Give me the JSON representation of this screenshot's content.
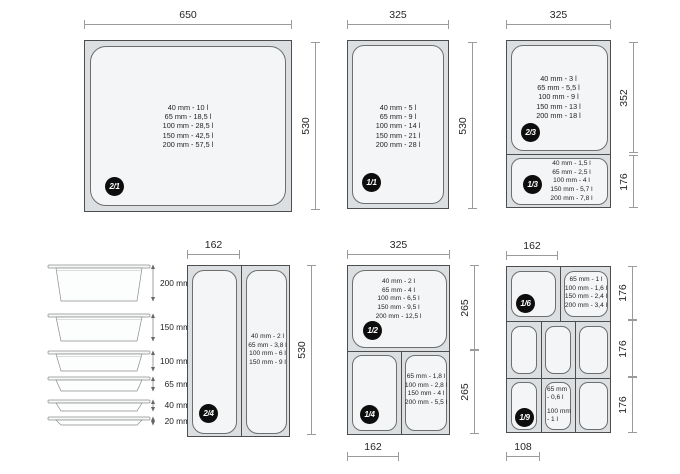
{
  "colors": {
    "pan_outer": "#dcdfe1",
    "pan_inner": "#f3f5f6",
    "pan_border": "#4d4d4d",
    "cell_border": "#6e6e6e",
    "dim": "#9b9b9b",
    "dim_text": "#262626",
    "badge_bg": "#0d0d0d",
    "badge_fg": "#ffffff",
    "caps_text": "#1f1f1f"
  },
  "gn21": {
    "badge": "2/1",
    "width": "650",
    "height": "530",
    "capacities": [
      "40 mm - 10 l",
      "65 mm - 18,5 l",
      "100 mm - 28,5 l",
      "150 mm - 42,5 l",
      "200 mm - 57,5 l"
    ]
  },
  "gn11": {
    "badge": "1/1",
    "width": "325",
    "height": "530",
    "capacities": [
      "40 mm - 5 l",
      "65 mm - 9 l",
      "100 mm - 14 l",
      "150 mm - 21 l",
      "200 mm - 28 l"
    ]
  },
  "gn23": {
    "badge": "2/3",
    "width": "325",
    "height": "352",
    "capacities": [
      "40 mm - 3 l",
      "65 mm - 5,5 l",
      "100 mm - 9 l",
      "150 mm - 13 l",
      "200 mm - 18 l"
    ]
  },
  "gn13": {
    "badge": "1/3",
    "height": "176",
    "capacities": [
      "40 mm - 1,5 l",
      "65 mm - 2,5 l",
      "100 mm - 4 l",
      "150 mm - 5,7 l",
      "200 mm - 7,8 l"
    ]
  },
  "stack": {
    "depths": [
      "200 mm",
      "150 mm",
      "100 mm",
      "65 mm",
      "40 mm",
      "20 mm"
    ]
  },
  "gn24": {
    "badge": "2/4",
    "width": "162",
    "height": "530",
    "capacities": [
      "40 mm - 2 l",
      "65 mm - 3,8 l",
      "100 mm - 6 l",
      "150 mm - 9 l"
    ]
  },
  "gn12": {
    "badge": "1/2",
    "width": "325",
    "height": "265",
    "capacities": [
      "40 mm - 2 l",
      "65 mm - 4 l",
      "100 mm - 6,5 l",
      "150 mm - 9,5 l",
      "200 mm - 12,5 l"
    ]
  },
  "gn14": {
    "badge": "1/4",
    "width": "162",
    "height": "265",
    "capacities": [
      "65 mm - 1,8 l",
      "100 mm - 2,8 l",
      "150 mm - 4 l",
      "200 mm - 5,5 l"
    ]
  },
  "gn16": {
    "badge": "1/6",
    "width": "162",
    "capacities": [
      "65 mm - 1 l",
      "100 mm - 1,6 l",
      "150 mm - 2,4 l",
      "200 mm - 3,4 l"
    ]
  },
  "gn19": {
    "badge": "1/9",
    "width": "108",
    "capacities": [
      "65 mm",
      "- 0,6 l",
      "100 mm",
      "- 1 l"
    ]
  },
  "gn_grid": {
    "row_heights": [
      "176",
      "176",
      "176"
    ]
  }
}
